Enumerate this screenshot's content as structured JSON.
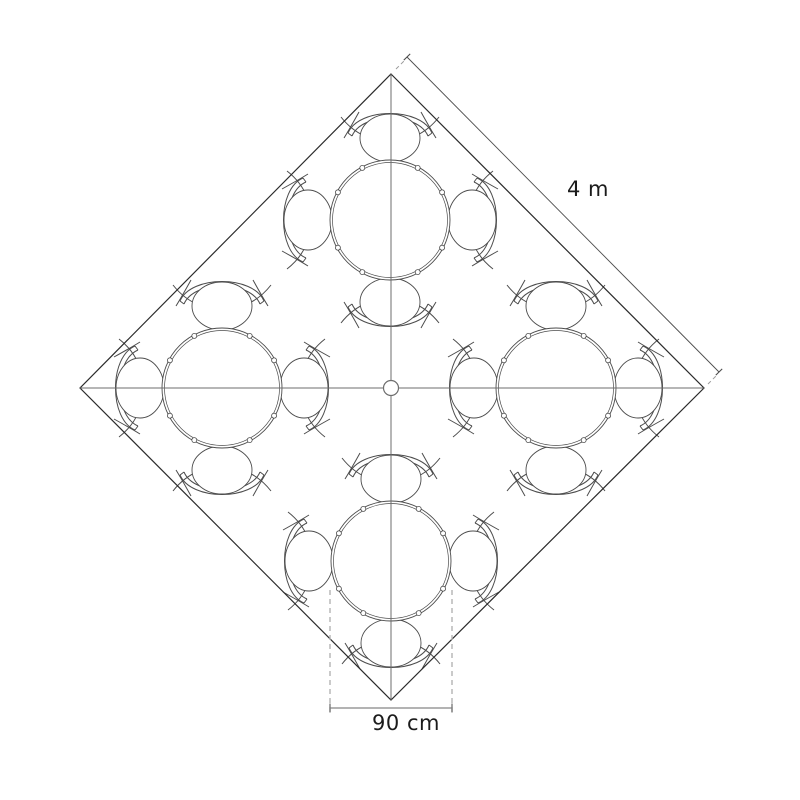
{
  "labels": {
    "edge_dimension": "4 m",
    "table_dimension": "90 cm"
  },
  "diagram": {
    "type": "floor-plan-top-view",
    "description": "Square room rotated 45 degrees containing four round tables, each with four chairs",
    "room": {
      "shape": "square-rotated-45",
      "side_length_label": "4 m",
      "corners": [
        [
          391,
          74
        ],
        [
          704,
          388
        ],
        [
          391,
          700
        ],
        [
          80,
          388
        ]
      ]
    },
    "axes": {
      "vertical": [
        [
          391,
          74
        ],
        [
          391,
          700
        ]
      ],
      "horizontal": [
        [
          80,
          388
        ],
        [
          704,
          388
        ]
      ]
    },
    "center_marker": {
      "cx": 391,
      "cy": 388,
      "r": 7.5
    },
    "tables": [
      {
        "id": "top",
        "cx": 390,
        "cy": 220
      },
      {
        "id": "left",
        "cx": 222,
        "cy": 388
      },
      {
        "id": "right",
        "cx": 556,
        "cy": 388
      },
      {
        "id": "bottom",
        "cx": 391,
        "cy": 561
      }
    ],
    "table_spec": {
      "radius": 60,
      "inner_radius": 57.5,
      "diameter_label": "90 cm",
      "chairs_per_table": 4,
      "chair_offset": 82,
      "edge_node_angles": [
        28,
        62,
        118,
        152,
        208,
        242,
        298,
        332
      ],
      "edge_node_radius": 2.5,
      "edge_node_ring": 59
    },
    "dim_edge": {
      "line": [
        [
          407,
          57
        ],
        [
          719,
          372
        ]
      ],
      "tick_half": 4.5,
      "ext_dashes": [
        [
          [
            396,
            69
          ],
          [
            405,
            60
          ]
        ],
        [
          [
            708,
            384
          ],
          [
            717,
            375
          ]
        ]
      ],
      "label_pos": {
        "x": 588,
        "y": 178
      }
    },
    "dim_table": {
      "dashed_x": [
        330,
        452
      ],
      "dashed_y": [
        590,
        712
      ],
      "line_y": 708,
      "line_x": [
        330,
        452
      ],
      "tick_half": 4.5,
      "label_pos": {
        "x": 406,
        "y": 712
      }
    },
    "colors": {
      "background": "#ffffff",
      "outline": "#2b2b2b",
      "axis": "#6e6e6e",
      "furniture": "#4c4c4c",
      "dimension": "#4c4c4c",
      "dim_gray": "#9a9a9a",
      "dim_tick": "#7d7d7d",
      "dashed": "#b4b4b4",
      "ext_dash": "#9a9a9a",
      "text": "#1b1b1b"
    }
  }
}
